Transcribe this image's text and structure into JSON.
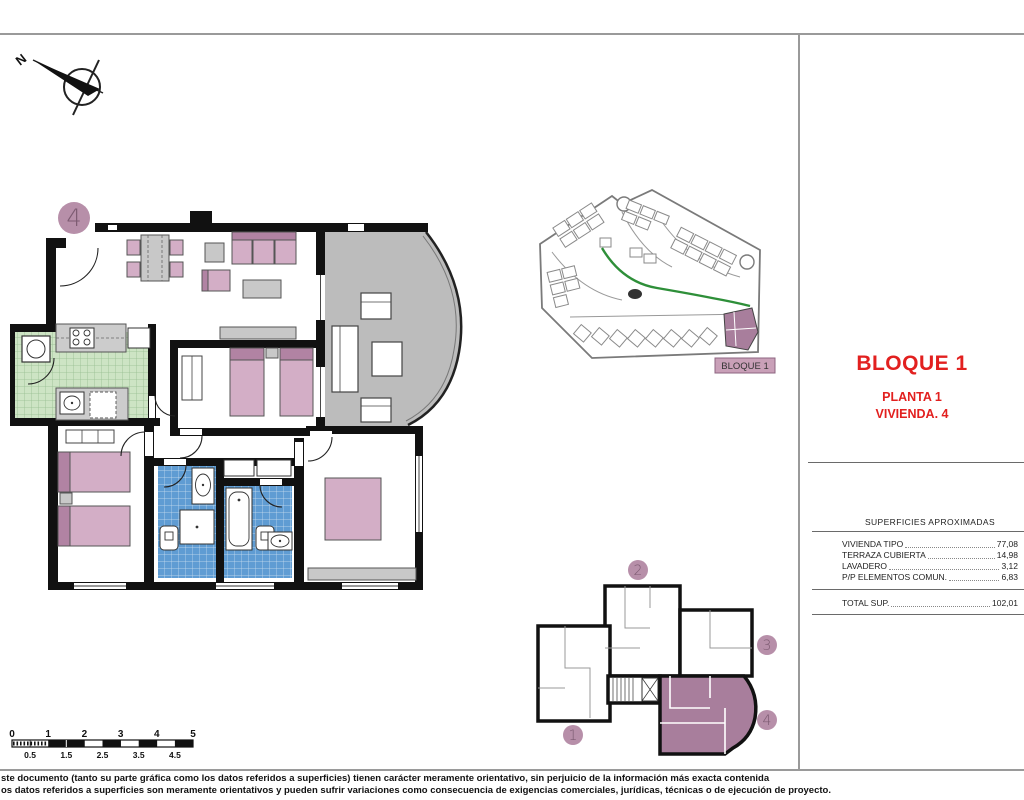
{
  "sheet": {
    "title_block": {
      "bloque": "BLOQUE 1",
      "planta": "PLANTA 1",
      "vivienda": "VIVIENDA. 4"
    },
    "surfaces": {
      "heading": "SUPERFICIES APROXIMADAS",
      "rows": [
        {
          "label": "VIVIENDA TIPO",
          "value": "77,08"
        },
        {
          "label": "TERRAZA CUBIERTA",
          "value": "14,98"
        },
        {
          "label": "LAVADERO",
          "value": "3,12"
        },
        {
          "label": "P/P ELEMENTOS COMUN.",
          "value": "6,83"
        }
      ],
      "total": {
        "label": "TOTAL SUP.",
        "value": "102,01"
      }
    },
    "floor_plan": {
      "unit_number": "4"
    },
    "site_plan": {
      "block_label": "BLOQUE 1"
    },
    "key_plan": {
      "unit_labels": [
        "1",
        "2",
        "3",
        "4"
      ],
      "highlighted_unit": "4"
    },
    "compass": {
      "north_label": "N"
    },
    "scale_bar": {
      "major_labels": [
        "0",
        "1",
        "2",
        "3",
        "4",
        "5"
      ],
      "minor_labels": [
        "0.5",
        "1.5",
        "2.5",
        "3.5",
        "4.5"
      ]
    },
    "footer": {
      "line1": "ste documento (tanto su parte gráfica como los datos referidos a superficies) tienen carácter meramente orientativo, sin perjuicio de la información más exacta contenida",
      "line2": "os datos referidos a superficies son meramente orientativos y pueden sufrir variaciones como consecuencia de exigencias comerciales, jurídicas, técnicas o de ejecución de proyecto."
    },
    "colors": {
      "accent_red": "#e2201f",
      "mauve": "#b78fa9",
      "mauve_dark": "#a87e9c",
      "bed_pink": "#d3aec6",
      "tile_green": "#cde4c4",
      "tile_blue": "#5f9cd3",
      "terrace_grey": "#bcbcbc"
    }
  }
}
